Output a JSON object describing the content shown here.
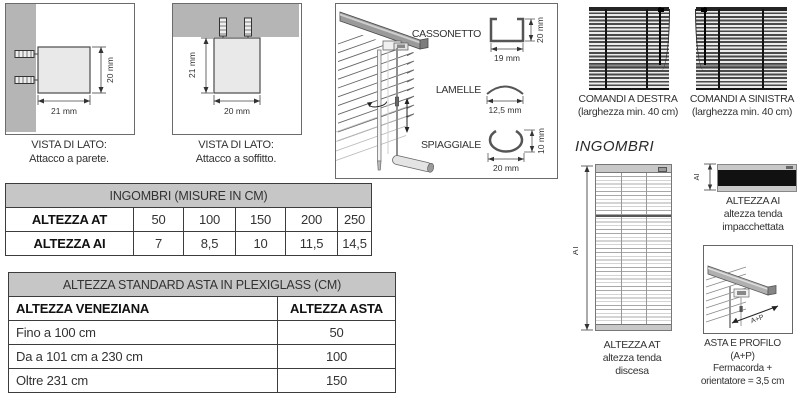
{
  "side_views": {
    "wall": {
      "title": "VISTA DI LATO:",
      "subtitle": "Attacco a parete.",
      "width_dim": "21 mm",
      "height_dim": "20 mm"
    },
    "ceiling": {
      "title": "VISTA DI LATO:",
      "subtitle": "Attacco a soffitto.",
      "width_dim": "20 mm",
      "height_dim": "21 mm"
    }
  },
  "components": {
    "cassonetto": {
      "label": "CASSONETTO",
      "width_dim": "19 mm",
      "height_dim": "20 mm"
    },
    "lamelle": {
      "label": "LAMELLE",
      "width_dim": "12,5 mm"
    },
    "spiaggiale": {
      "label": "SPIAGGIALE",
      "width_dim": "20 mm",
      "height_dim": "10 mm"
    }
  },
  "controls": {
    "destra": {
      "title": "COMANDI A DESTRA",
      "subtitle": "(larghezza min. 40 cm)"
    },
    "sinistra": {
      "title": "COMANDI A SINISTRA",
      "subtitle": "(larghezza min. 40 cm)"
    }
  },
  "ingombri": {
    "heading": "INGOMBRI",
    "at": {
      "dim_label": "AT",
      "line1": "ALTEZZA AT",
      "line2": "altezza tenda",
      "line3": "discesa"
    },
    "ai": {
      "dim_label": "AI",
      "line1": "ALTEZZA AI",
      "line2": "altezza tenda",
      "line3": "impacchettata"
    },
    "asta_profilo": {
      "dim_label": "A+P",
      "line1": "ASTA E PROFILO",
      "line2": "(A+P)",
      "line3": "Fermacorda +",
      "line4": "orientatore = 3,5 cm"
    }
  },
  "tables": {
    "ingombri": {
      "title": "INGOMBRI (MISURE IN CM)",
      "rows": [
        {
          "label": "ALTEZZA AT",
          "values": [
            "50",
            "100",
            "150",
            "200",
            "250"
          ]
        },
        {
          "label": "ALTEZZA AI",
          "values": [
            "7",
            "8,5",
            "10",
            "11,5",
            "14,5"
          ]
        }
      ]
    },
    "asta": {
      "title": "ALTEZZA STANDARD ASTA IN PLEXIGLASS (CM)",
      "col_label": "ALTEZZA VENEZIANA",
      "col_value": "ALTEZZA ASTA",
      "rows": [
        {
          "label": "Fino a 100 cm",
          "value": "50"
        },
        {
          "label": "Da a 101 cm a 230 cm",
          "value": "100"
        },
        {
          "label": "Oltre 231 cm",
          "value": "150"
        }
      ]
    }
  },
  "colors": {
    "header_bg": "#c6c6c6",
    "wall_gray": "#b5b5b5",
    "line": "#444444",
    "blind_dark": "#111111"
  }
}
